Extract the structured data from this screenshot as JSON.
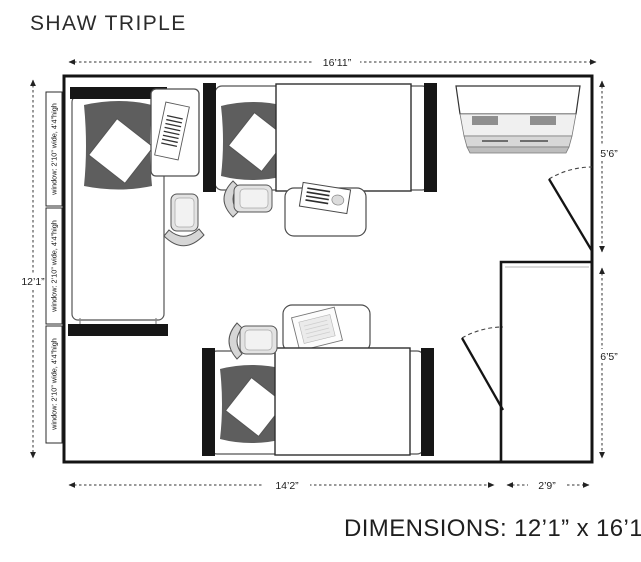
{
  "title": "SHAW TRIPLE",
  "footer": {
    "dimensions_text": "DIMENSIONS: 12’1” x 16’11”"
  },
  "dims": {
    "top": "16’11”",
    "left": "12’1”",
    "right_upper": "5’6”",
    "right_lower": "6’5”",
    "bottom_main": "14’2”",
    "bottom_closet": "2’9”"
  },
  "windows": {
    "count": 3,
    "label": "window: 2’10” wide, 4’4”high"
  },
  "furniture": [
    "bed",
    "bed",
    "bed",
    "desk",
    "desk",
    "desk",
    "chair",
    "chair",
    "chair",
    "dresser",
    "closet",
    "entry-door",
    "closet-door"
  ],
  "colors": {
    "wall": "#141414",
    "comforter": "#5e5e5e",
    "furniture_stroke": "#4d4d4d",
    "chair_fill": "#e3e3e3",
    "text": "#2b2b2b",
    "background": "#ffffff"
  }
}
